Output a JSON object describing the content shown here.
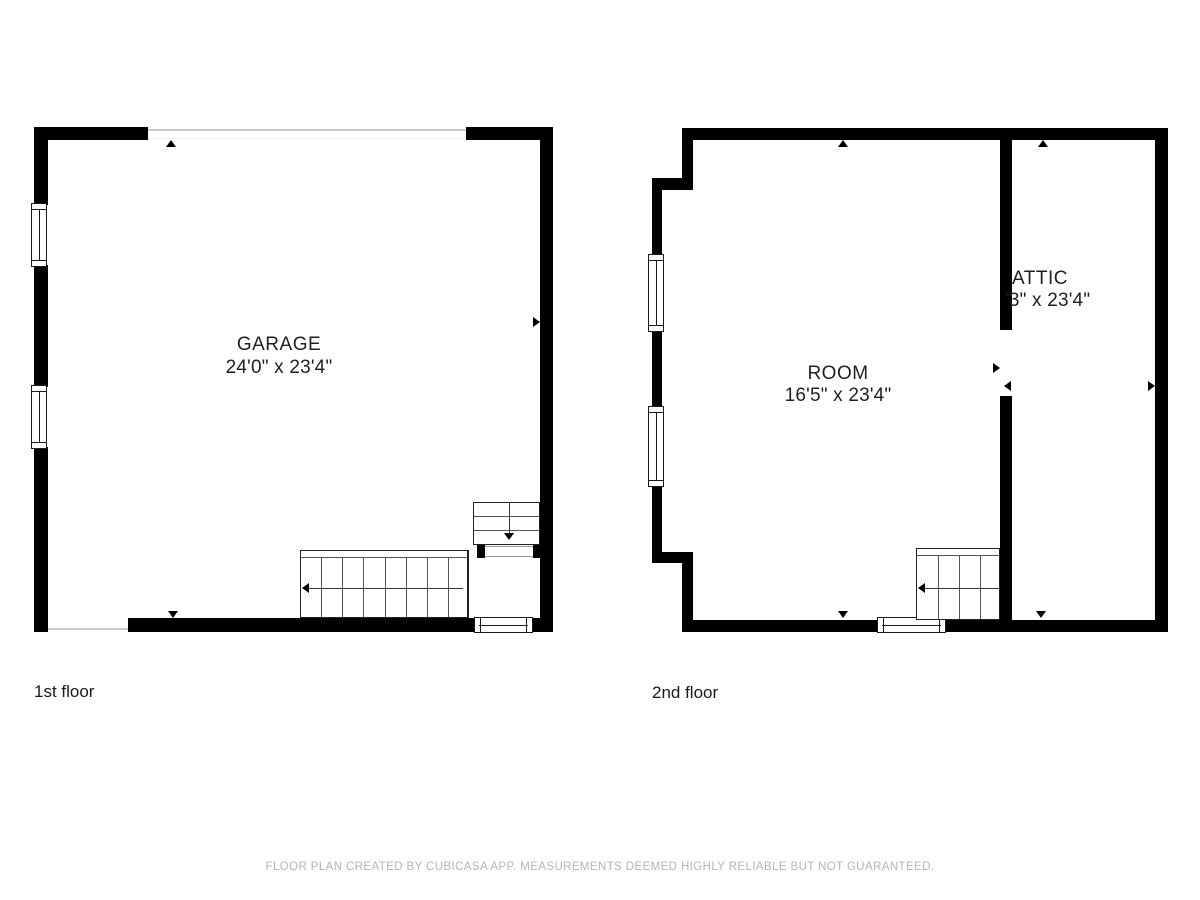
{
  "floors": [
    {
      "label": "1st floor",
      "rooms": [
        {
          "name": "GARAGE",
          "dimensions": "24'0\" x 23'4\""
        }
      ]
    },
    {
      "label": "2nd floor",
      "rooms": [
        {
          "name": "ROOM",
          "dimensions": "16'5\" x 23'4\""
        },
        {
          "name": "ATTIC",
          "dimensions": "'3\" x 23'4\""
        }
      ]
    }
  ],
  "footer": {
    "disclaimer": "FLOOR PLAN CREATED BY CUBICASA APP. MEASUREMENTS DEEMED HIGHLY RELIABLE BUT NOT GUARANTEED."
  },
  "colors": {
    "wall": "#000000",
    "stair_outline": "#222222",
    "tread_line": "#555555",
    "door_opening_line": "#cccccc",
    "label_text": "#1f1f1f",
    "footer_text": "#b5b5b5"
  }
}
